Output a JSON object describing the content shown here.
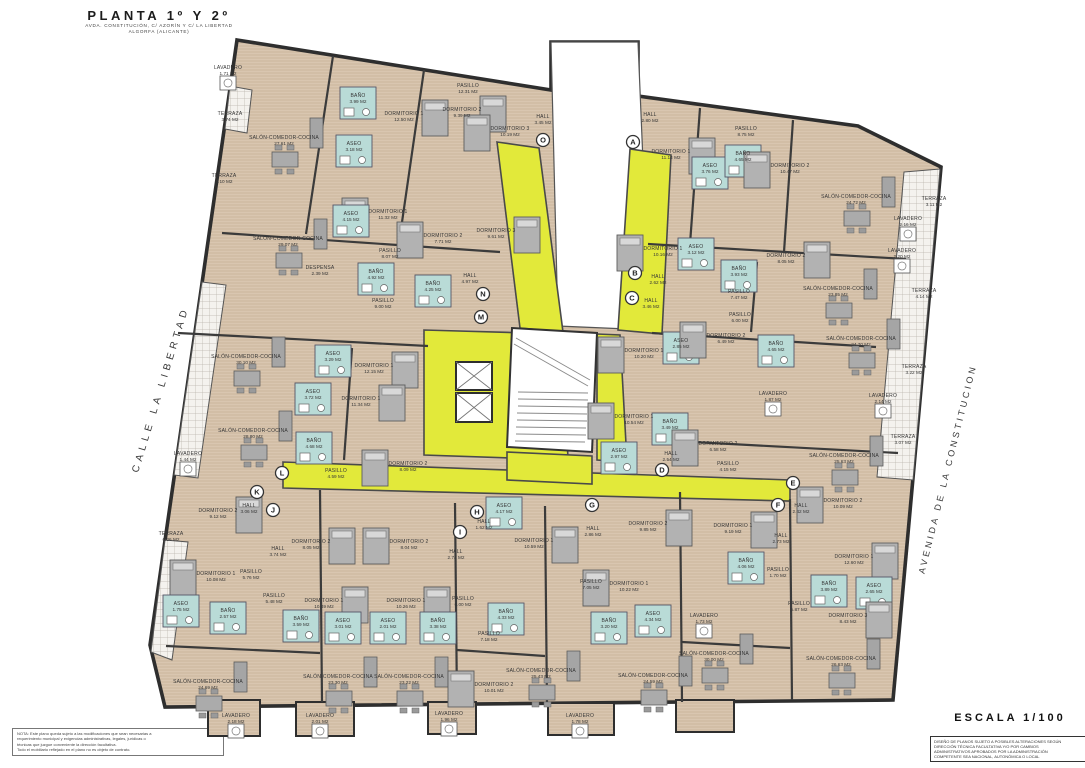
{
  "title_block": {
    "title": "PLANTA 1º Y 2º",
    "subtitle_line1": "AVDA. CONSTITUCIÓN, C/ AZORÍN Y C/ LA LIBERTAD",
    "subtitle_line2": "ALGORFA (ALICANTE)"
  },
  "street_labels": {
    "left": "CALLE LA LIBERTAD",
    "right": "AVENIDA DE LA CONSTITUCION"
  },
  "scale_block": {
    "scale": "ESCALA 1/100",
    "disclaimer_lines": [
      "DISEÑO DE PLANOS SUJETO A POSIBLES ALTERACIONES SEGÚN",
      "DIRECCIÓN TÉCNICA FACULTATIVA Y/O POR CAMBIOS",
      "ADMINISTRATIVOS APROBADOS POR LA ADMINISTRACIÓN",
      "COMPETENTE SEA NACIONAL, AUTONÓMICA O LOCAL"
    ]
  },
  "note_block": {
    "lines": [
      "NOTA: Este plano queda sujeto a las modificaciones que sean necesarias a",
      "requerimiento municipal y exigencias administrativas, legales, jurídicas o",
      "técnicas que juzgue conveniente la dirección facultativa.",
      "Todo el mobiliario reflejado en el plano no es objeto de contrato."
    ]
  },
  "colors": {
    "floor": "#d9c6b0",
    "floor_stripe": "#c6af93",
    "corridor": "#e2e93a",
    "wet_room": "#b9dbd7",
    "wall": "#3b3b3b",
    "furniture": "#b0b0b0"
  },
  "unit_markers": [
    {
      "letter": "A",
      "x": 633,
      "y": 142
    },
    {
      "letter": "O",
      "x": 543,
      "y": 140
    },
    {
      "letter": "B",
      "x": 635,
      "y": 273
    },
    {
      "letter": "C",
      "x": 632,
      "y": 298
    },
    {
      "letter": "N",
      "x": 483,
      "y": 294
    },
    {
      "letter": "M",
      "x": 481,
      "y": 317
    },
    {
      "letter": "D",
      "x": 662,
      "y": 470
    },
    {
      "letter": "E",
      "x": 793,
      "y": 483
    },
    {
      "letter": "F",
      "x": 778,
      "y": 505
    },
    {
      "letter": "G",
      "x": 592,
      "y": 505
    },
    {
      "letter": "H",
      "x": 477,
      "y": 512
    },
    {
      "letter": "I",
      "x": 460,
      "y": 532
    },
    {
      "letter": "J",
      "x": 273,
      "y": 510
    },
    {
      "letter": "K",
      "x": 257,
      "y": 492
    },
    {
      "letter": "L",
      "x": 282,
      "y": 473
    }
  ],
  "rooms": [
    {
      "name": "LAVADERO",
      "area": "1.71 M2",
      "x": 228,
      "y": 70
    },
    {
      "name": "TERRAZA",
      "area": "3.74 M2",
      "x": 230,
      "y": 116
    },
    {
      "name": "SALÓN-COMEDOR-COCINA",
      "area": "27.61 M2",
      "x": 284,
      "y": 140
    },
    {
      "name": "BAÑO",
      "area": "3.99 M2",
      "x": 358,
      "y": 98
    },
    {
      "name": "DORMITORIO 1",
      "area": "12.50 M2",
      "x": 404,
      "y": 116
    },
    {
      "name": "ASEO",
      "area": "3.18 M2",
      "x": 354,
      "y": 146
    },
    {
      "name": "TERRAZA",
      "area": "3.10 M2",
      "x": 224,
      "y": 178
    },
    {
      "name": "DORMITORIO 1",
      "area": "11.32 M2",
      "x": 388,
      "y": 214
    },
    {
      "name": "ASEO",
      "area": "4.15 M2",
      "x": 351,
      "y": 216
    },
    {
      "name": "PASILLO",
      "area": "12.31 M2",
      "x": 468,
      "y": 88
    },
    {
      "name": "DORMITORIO 2",
      "area": "9.39 M2",
      "x": 462,
      "y": 112
    },
    {
      "name": "DORMITORIO 3",
      "area": "10.19 M2",
      "x": 510,
      "y": 131
    },
    {
      "name": "HALL",
      "area": "3.45 M2",
      "x": 543,
      "y": 119
    },
    {
      "name": "HALL",
      "area": "2.80 M2",
      "x": 650,
      "y": 117
    },
    {
      "name": "DORMITORIO 3",
      "area": "9.61 M2",
      "x": 496,
      "y": 233
    },
    {
      "name": "DORMITORIO 2",
      "area": "7.71 M2",
      "x": 443,
      "y": 238
    },
    {
      "name": "SALÓN-COMEDOR-COCINA",
      "area": "29.07 M2",
      "x": 288,
      "y": 241
    },
    {
      "name": "PASILLO",
      "area": "8.07 M2",
      "x": 390,
      "y": 253
    },
    {
      "name": "DESPENSA",
      "area": "2.39 M2",
      "x": 320,
      "y": 270
    },
    {
      "name": "BAÑO",
      "area": "4.92 M2",
      "x": 376,
      "y": 274
    },
    {
      "name": "BAÑO",
      "area": "4.25 M2",
      "x": 433,
      "y": 286
    },
    {
      "name": "HALL",
      "area": "4.97 M2",
      "x": 470,
      "y": 278
    },
    {
      "name": "PASILLO",
      "area": "9.00 M2",
      "x": 383,
      "y": 303
    },
    {
      "name": "PASILLO",
      "area": "8.75 M2",
      "x": 746,
      "y": 131
    },
    {
      "name": "DORMITORIO 1",
      "area": "11.14 M2",
      "x": 671,
      "y": 154
    },
    {
      "name": "ASEO",
      "area": "3.76 M2",
      "x": 710,
      "y": 168
    },
    {
      "name": "BAÑO",
      "area": "4.65 M2",
      "x": 743,
      "y": 156
    },
    {
      "name": "DORMITORIO 2",
      "area": "10.47 M2",
      "x": 790,
      "y": 168
    },
    {
      "name": "SALÓN-COMEDOR-COCINA",
      "area": "24.72 M2",
      "x": 856,
      "y": 199
    },
    {
      "name": "LAVADERO",
      "area": "2.16 M2",
      "x": 908,
      "y": 221
    },
    {
      "name": "TERRAZA",
      "area": "3.11 M2",
      "x": 934,
      "y": 201
    },
    {
      "name": "DORMITORIO 1",
      "area": "10.16 M2",
      "x": 663,
      "y": 251
    },
    {
      "name": "ASEO",
      "area": "3.12 M2",
      "x": 696,
      "y": 249
    },
    {
      "name": "BAÑO",
      "area": "3.93 M2",
      "x": 739,
      "y": 271
    },
    {
      "name": "DORMITORIO 2",
      "area": "8.05 M2",
      "x": 786,
      "y": 258
    },
    {
      "name": "LAVADERO",
      "area": "2.20 M2",
      "x": 902,
      "y": 253
    },
    {
      "name": "SALÓN-COMEDOR-COCINA",
      "area": "23.85 M2",
      "x": 838,
      "y": 291
    },
    {
      "name": "HALL",
      "area": "2.62 M2",
      "x": 658,
      "y": 279
    },
    {
      "name": "PASILLO",
      "area": "7.47 M2",
      "x": 739,
      "y": 294
    },
    {
      "name": "HALL",
      "area": "3.46 M2",
      "x": 651,
      "y": 303
    },
    {
      "name": "PASILLO",
      "area": "6.00 M2",
      "x": 740,
      "y": 317
    },
    {
      "name": "DORMITORIO 1",
      "area": "10.20 M2",
      "x": 644,
      "y": 353
    },
    {
      "name": "ASEO",
      "area": "2.85 M2",
      "x": 681,
      "y": 343
    },
    {
      "name": "DORMITORIO 2",
      "area": "6.49 M2",
      "x": 726,
      "y": 338
    },
    {
      "name": "BAÑO",
      "area": "4.65 M2",
      "x": 776,
      "y": 346
    },
    {
      "name": "SALÓN-COMEDOR-COCINA",
      "area": "24.70 M2",
      "x": 861,
      "y": 341
    },
    {
      "name": "TERRAZA",
      "area": "3.22 M2",
      "x": 914,
      "y": 369
    },
    {
      "name": "LAVADERO",
      "area": "1.87 M2",
      "x": 773,
      "y": 396
    },
    {
      "name": "LAVADERO",
      "area": "2.14 M2",
      "x": 883,
      "y": 398
    },
    {
      "name": "DORMITORIO 1",
      "area": "10.54 M2",
      "x": 634,
      "y": 419
    },
    {
      "name": "BAÑO",
      "area": "3.49 M2",
      "x": 670,
      "y": 424
    },
    {
      "name": "ASEO",
      "area": "2.97 M2",
      "x": 619,
      "y": 453
    },
    {
      "name": "HALL",
      "area": "2.54 M2",
      "x": 671,
      "y": 456
    },
    {
      "name": "DORMITORIO 2",
      "area": "6.58 M2",
      "x": 718,
      "y": 446
    },
    {
      "name": "PASILLO",
      "area": "4.15 M2",
      "x": 728,
      "y": 466
    },
    {
      "name": "SALÓN-COMEDOR-COCINA",
      "area": "25.63 M2",
      "x": 844,
      "y": 458
    },
    {
      "name": "TERRAZA",
      "area": "3.07 M2",
      "x": 903,
      "y": 439
    },
    {
      "name": "TERRAZA",
      "area": "4.14 M2",
      "x": 924,
      "y": 293
    },
    {
      "name": "SALÓN-COMEDOR-COCINA",
      "area": "30.10 M2",
      "x": 246,
      "y": 359
    },
    {
      "name": "ASEO",
      "area": "3.29 M2",
      "x": 333,
      "y": 356
    },
    {
      "name": "DORMITORIO 1",
      "area": "12.15 M2",
      "x": 374,
      "y": 368
    },
    {
      "name": "ASEO",
      "area": "3.72 M2",
      "x": 313,
      "y": 394
    },
    {
      "name": "DORMITORIO 1",
      "area": "11.34 M2",
      "x": 361,
      "y": 401
    },
    {
      "name": "SALÓN-COMEDOR-COCINA",
      "area": "28.80 M2",
      "x": 253,
      "y": 433
    },
    {
      "name": "BAÑO",
      "area": "4.68 M2",
      "x": 314,
      "y": 443
    },
    {
      "name": "LAVADERO",
      "area": "1.44 M2",
      "x": 188,
      "y": 456
    },
    {
      "name": "PASILLO",
      "area": "4.59 M2",
      "x": 336,
      "y": 473
    },
    {
      "name": "DORMITORIO 2",
      "area": "8.09 M2",
      "x": 408,
      "y": 466
    },
    {
      "name": "DORMITORIO 2",
      "area": "9.12 M2",
      "x": 218,
      "y": 513
    },
    {
      "name": "HALL",
      "area": "3.06 M2",
      "x": 249,
      "y": 508
    },
    {
      "name": "TERRAZA",
      "area": "6.26 M2",
      "x": 171,
      "y": 536
    },
    {
      "name": "HALL",
      "area": "3.74 M2",
      "x": 278,
      "y": 551
    },
    {
      "name": "DORMITORIO 2",
      "area": "8.05 M2",
      "x": 311,
      "y": 544
    },
    {
      "name": "DORMITORIO 1",
      "area": "10.08 M2",
      "x": 216,
      "y": 576
    },
    {
      "name": "PASILLO",
      "area": "5.76 M2",
      "x": 251,
      "y": 574
    },
    {
      "name": "PASILLO",
      "area": "5.48 M2",
      "x": 274,
      "y": 598
    },
    {
      "name": "DORMITORIO 1",
      "area": "10.49 M2",
      "x": 324,
      "y": 603
    },
    {
      "name": "DORMITORIO 2",
      "area": "8.04 M2",
      "x": 409,
      "y": 544
    },
    {
      "name": "DORMITORIO 1",
      "area": "10.26 M2",
      "x": 406,
      "y": 603
    },
    {
      "name": "ASEO",
      "area": "1.75 M2",
      "x": 181,
      "y": 606
    },
    {
      "name": "BAÑO",
      "area": "2.57 M2",
      "x": 228,
      "y": 613
    },
    {
      "name": "BAÑO",
      "area": "3.59 M2",
      "x": 301,
      "y": 621
    },
    {
      "name": "ASEO",
      "area": "3.01 M2",
      "x": 343,
      "y": 623
    },
    {
      "name": "ASEO",
      "area": "2.01 M2",
      "x": 388,
      "y": 623
    },
    {
      "name": "SALÓN-COMEDOR-COCINA",
      "area": "24.69 M2",
      "x": 208,
      "y": 684
    },
    {
      "name": "SALÓN-COMEDOR-COCINA",
      "area": "23.30 M2",
      "x": 338,
      "y": 679
    },
    {
      "name": "SALÓN-COMEDOR-COCINA",
      "area": "23.22 M2",
      "x": 409,
      "y": 679
    },
    {
      "name": "LAVADERO",
      "area": "2.18 M2",
      "x": 236,
      "y": 718
    },
    {
      "name": "LAVADERO",
      "area": "2.01 M2",
      "x": 320,
      "y": 718
    },
    {
      "name": "LAVADERO",
      "area": "1.96 M2",
      "x": 449,
      "y": 716
    },
    {
      "name": "ASEO",
      "area": "4.17 M2",
      "x": 504,
      "y": 508
    },
    {
      "name": "HALL",
      "area": "1.62 M2",
      "x": 484,
      "y": 524
    },
    {
      "name": "DORMITORIO 1",
      "area": "10.59 M2",
      "x": 534,
      "y": 543
    },
    {
      "name": "HALL",
      "area": "2.86 M2",
      "x": 593,
      "y": 531
    },
    {
      "name": "DORMITORIO 2",
      "area": "9.85 M2",
      "x": 648,
      "y": 526
    },
    {
      "name": "HALL",
      "area": "2.74 M2",
      "x": 456,
      "y": 554
    },
    {
      "name": "PASILLO",
      "area": "6.00 M2",
      "x": 463,
      "y": 601
    },
    {
      "name": "BAÑO",
      "area": "3.38 M2",
      "x": 438,
      "y": 623
    },
    {
      "name": "BAÑO",
      "area": "4.33 M2",
      "x": 506,
      "y": 614
    },
    {
      "name": "PASILLO",
      "area": "7.18 M2",
      "x": 489,
      "y": 636
    },
    {
      "name": "PASILLO",
      "area": "7.05 M2",
      "x": 591,
      "y": 584
    },
    {
      "name": "DORMITORIO 1",
      "area": "10.22 M2",
      "x": 629,
      "y": 586
    },
    {
      "name": "BAÑO",
      "area": "3.20 M2",
      "x": 609,
      "y": 623
    },
    {
      "name": "ASEO",
      "area": "4.34 M2",
      "x": 653,
      "y": 616
    },
    {
      "name": "SALÓN-COMEDOR-COCINA",
      "area": "25.43 M2",
      "x": 541,
      "y": 673
    },
    {
      "name": "DORMITORIO 2",
      "area": "10.01 M2",
      "x": 494,
      "y": 687
    },
    {
      "name": "LAVADERO",
      "area": "1.78 M2",
      "x": 580,
      "y": 718
    },
    {
      "name": "SALÓN-COMEDOR-COCINA",
      "area": "24.59 M2",
      "x": 653,
      "y": 678
    },
    {
      "name": "HALL",
      "area": "2.42 M2",
      "x": 801,
      "y": 508
    },
    {
      "name": "DORMITORIO 2",
      "area": "10.09 M2",
      "x": 843,
      "y": 503
    },
    {
      "name": "DORMITORIO 1",
      "area": "9.19 M2",
      "x": 733,
      "y": 528
    },
    {
      "name": "HALL",
      "area": "2.73 M2",
      "x": 781,
      "y": 538
    },
    {
      "name": "BAÑO",
      "area": "4.06 M2",
      "x": 746,
      "y": 563
    },
    {
      "name": "PASILLO",
      "area": "1.70 M2",
      "x": 778,
      "y": 572
    },
    {
      "name": "DORMITORIO 1",
      "area": "12.60 M2",
      "x": 854,
      "y": 559
    },
    {
      "name": "BAÑO",
      "area": "3.89 M2",
      "x": 829,
      "y": 586
    },
    {
      "name": "ASEO",
      "area": "2.65 M2",
      "x": 874,
      "y": 588
    },
    {
      "name": "PASILLO",
      "area": "6.87 M2",
      "x": 799,
      "y": 606
    },
    {
      "name": "DORMITORIO 3",
      "area": "8.43 M2",
      "x": 848,
      "y": 618
    },
    {
      "name": "LAVADERO",
      "area": "1.73 M2",
      "x": 704,
      "y": 618
    },
    {
      "name": "SALÓN-COMEDOR-COCINA",
      "area": "30.00 M2",
      "x": 714,
      "y": 656
    },
    {
      "name": "SALÓN-COMEDOR-COCINA",
      "area": "26.63 M2",
      "x": 841,
      "y": 661
    }
  ]
}
